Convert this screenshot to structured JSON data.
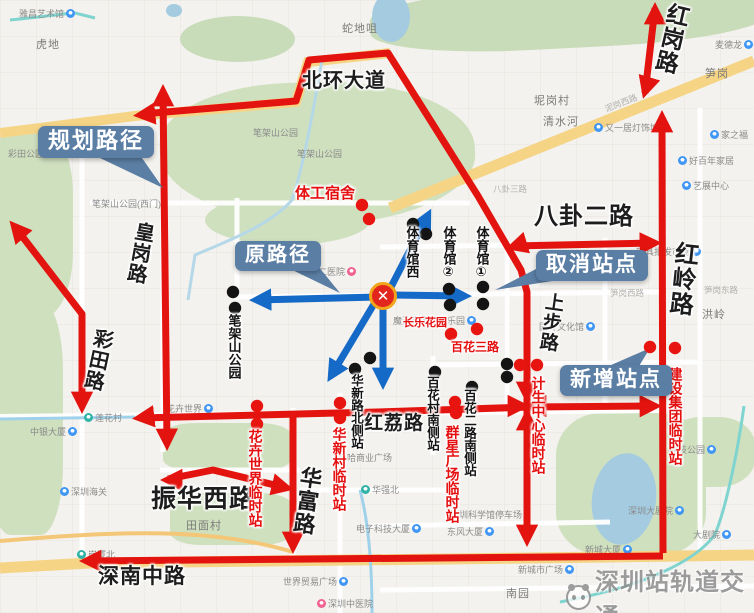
{
  "colors": {
    "route_planned_red": "#e3140f",
    "route_original_blue": "#1569c7",
    "callout_bg": "#5b7ea4",
    "cancelled_dot": "#141414",
    "new_dot": "#e8140f",
    "park_green": "#cfe0bf",
    "road_yellow": "#f5d485",
    "water_blue": "#a4cbe0"
  },
  "callouts": {
    "planned": {
      "label": "规划路径"
    },
    "original": {
      "label": "原路径"
    },
    "cancelled": {
      "label": "取消站点"
    },
    "added": {
      "label": "新增站点"
    }
  },
  "center_marker": {
    "symbol": "✕"
  },
  "watermark": {
    "text": "深圳站轨道交通"
  },
  "road_labels": [
    {
      "text": "北环大道",
      "x": 302,
      "y": 71,
      "size": 20,
      "orient": "h",
      "rot": 0
    },
    {
      "text": "红岗路",
      "x": 658,
      "y": 2,
      "size": 23,
      "orient": "v",
      "rot": 13
    },
    {
      "text": "红岭路",
      "x": 668,
      "y": 241,
      "size": 24,
      "orient": "v",
      "rot": 6
    },
    {
      "text": "八卦二路",
      "x": 534,
      "y": 205,
      "size": 24,
      "orient": "h",
      "rot": 0
    },
    {
      "text": "上步路",
      "x": 540,
      "y": 292,
      "size": 19,
      "orient": "v",
      "rot": 8
    },
    {
      "text": "皇岗路",
      "x": 128,
      "y": 221,
      "size": 20,
      "orient": "v",
      "rot": 10
    },
    {
      "text": "彩田路",
      "x": 86,
      "y": 328,
      "size": 20,
      "orient": "v",
      "rot": 12
    },
    {
      "text": "红荔路",
      "x": 364,
      "y": 414,
      "size": 19,
      "orient": "h",
      "rot": 0
    },
    {
      "text": "华富路",
      "x": 294,
      "y": 466,
      "size": 22,
      "orient": "v",
      "rot": 8
    },
    {
      "text": "振华西路",
      "x": 151,
      "y": 486,
      "size": 25,
      "orient": "h",
      "rot": 0
    },
    {
      "text": "深南中路",
      "x": 98,
      "y": 566,
      "size": 21,
      "orient": "h",
      "rot": 0
    }
  ],
  "stations": [
    {
      "text": "体育馆西",
      "x": 405,
      "y": 226,
      "color": "black",
      "orient": "v",
      "size": 13
    },
    {
      "text": "体育馆②",
      "x": 442,
      "y": 226,
      "color": "black",
      "orient": "v",
      "size": 13
    },
    {
      "text": "体育馆①",
      "x": 475,
      "y": 226,
      "color": "black",
      "orient": "v",
      "size": 13
    },
    {
      "text": "笔架山公园",
      "x": 227,
      "y": 314,
      "color": "black",
      "orient": "v",
      "size": 13
    },
    {
      "text": "华新路北侧站",
      "x": 349,
      "y": 374,
      "color": "black",
      "orient": "v",
      "size": 12.5
    },
    {
      "text": "百花村南侧站",
      "x": 425,
      "y": 376,
      "color": "black",
      "orient": "v",
      "size": 12.5
    },
    {
      "text": "百花二路南侧站",
      "x": 462,
      "y": 389,
      "color": "black",
      "orient": "v",
      "size": 12.5
    },
    {
      "text": "花卉世界临时站",
      "x": 248,
      "y": 429,
      "color": "red",
      "orient": "v",
      "size": 14
    },
    {
      "text": "华新村临时站",
      "x": 332,
      "y": 427,
      "color": "red",
      "orient": "v",
      "size": 14
    },
    {
      "text": "群星广场临时站",
      "x": 445,
      "y": 425,
      "color": "red",
      "orient": "v",
      "size": 14
    },
    {
      "text": "计生中心临时站",
      "x": 531,
      "y": 376,
      "color": "red",
      "orient": "v",
      "size": 14
    },
    {
      "text": "建设集团临时站",
      "x": 668,
      "y": 367,
      "color": "red",
      "orient": "v",
      "size": 14
    },
    {
      "text": "体工宿舍",
      "x": 295,
      "y": 186,
      "color": "red",
      "orient": "h",
      "size": 15
    },
    {
      "text": "长乐花园",
      "x": 403,
      "y": 318,
      "color": "red",
      "orient": "h",
      "size": 11
    },
    {
      "text": "百花三路",
      "x": 451,
      "y": 341,
      "color": "red",
      "orient": "h",
      "size": 12
    }
  ],
  "dots": {
    "cancelled": [
      [
        233,
        292
      ],
      [
        235,
        308
      ],
      [
        413,
        224
      ],
      [
        426,
        234
      ],
      [
        449,
        289
      ],
      [
        450,
        305
      ],
      [
        483,
        287
      ],
      [
        483,
        304
      ],
      [
        370,
        358
      ],
      [
        355,
        369
      ],
      [
        435,
        372
      ],
      [
        472,
        387
      ],
      [
        507,
        364
      ],
      [
        507,
        377
      ]
    ],
    "new": [
      [
        362,
        205
      ],
      [
        369,
        219
      ],
      [
        451,
        334
      ],
      [
        477,
        329
      ],
      [
        520,
        365
      ],
      [
        537,
        365
      ],
      [
        650,
        347
      ],
      [
        675,
        348
      ],
      [
        257,
        406
      ],
      [
        257,
        424
      ],
      [
        340,
        403
      ],
      [
        340,
        418
      ],
      [
        455,
        402
      ],
      [
        456,
        413
      ]
    ]
  },
  "pois": [
    {
      "text": "雅昌艺术馆",
      "x": 19,
      "y": 7,
      "icon": "b",
      "side": "r"
    },
    {
      "text": "虎地",
      "x": 36,
      "y": 36,
      "big": true
    },
    {
      "text": "彩田公园",
      "x": 8,
      "y": 147
    },
    {
      "text": "笔架山公园(西门)",
      "x": 92,
      "y": 197
    },
    {
      "text": "笔架山公园",
      "x": 253,
      "y": 126
    },
    {
      "text": "笔架山公园",
      "x": 297,
      "y": 147
    },
    {
      "text": "蛇地咀",
      "x": 342,
      "y": 20,
      "big": true
    },
    {
      "text": "坭岗村",
      "x": 534,
      "y": 92,
      "big": true
    },
    {
      "text": "清水河",
      "x": 543,
      "y": 113,
      "big": true
    },
    {
      "text": "又一居灯饰城",
      "x": 594,
      "y": 121,
      "icon": "b",
      "side": "l"
    },
    {
      "text": "笋岗",
      "x": 705,
      "y": 65,
      "big": true
    },
    {
      "text": "麦德龙",
      "x": 715,
      "y": 38,
      "icon": "b",
      "side": "r"
    },
    {
      "text": "家之福",
      "x": 710,
      "y": 128,
      "icon": "b",
      "side": "l"
    },
    {
      "text": "好百年家居",
      "x": 678,
      "y": 154,
      "icon": "b",
      "side": "l"
    },
    {
      "text": "艺展中心",
      "x": 682,
      "y": 179,
      "icon": "b",
      "side": "l"
    },
    {
      "text": "玩具批发市场",
      "x": 636,
      "y": 245,
      "icon": "b",
      "side": "r"
    },
    {
      "text": "市第二医院",
      "x": 300,
      "y": 265,
      "icon": "p",
      "side": "r"
    },
    {
      "text": "魔法宝宝儿童乐园",
      "x": 393,
      "y": 314,
      "icon": "b",
      "side": "r"
    },
    {
      "text": "园岭文化馆",
      "x": 539,
      "y": 320,
      "icon": "b",
      "side": "r"
    },
    {
      "text": "洪岭",
      "x": 702,
      "y": 306,
      "big": true
    },
    {
      "text": "笋岗西路",
      "x": 610,
      "y": 287,
      "tiny": true
    },
    {
      "text": "笋岗东路",
      "x": 704,
      "y": 284,
      "tiny": true
    },
    {
      "text": "八卦三路",
      "x": 493,
      "y": 183,
      "tiny": true
    },
    {
      "text": "泥岗西路",
      "x": 604,
      "y": 97,
      "tiny": true,
      "rot": -21
    },
    {
      "text": "荔枝公园",
      "x": 669,
      "y": 443,
      "icon": "b",
      "side": "r"
    },
    {
      "text": "深圳大剧院",
      "x": 628,
      "y": 504,
      "icon": "b",
      "side": "r"
    },
    {
      "text": "大剧院",
      "x": 693,
      "y": 528,
      "icon": "b",
      "side": "r"
    },
    {
      "text": "新城大厦",
      "x": 585,
      "y": 543,
      "icon": "b",
      "side": "r"
    },
    {
      "text": "新城市广场",
      "x": 518,
      "y": 563,
      "icon": "b",
      "side": "r"
    },
    {
      "text": "东风大厦",
      "x": 447,
      "y": 525,
      "icon": "b",
      "side": "r"
    },
    {
      "text": "深圳科学馆停车场",
      "x": 450,
      "y": 508
    },
    {
      "text": "曼哈商业广场",
      "x": 338,
      "y": 451
    },
    {
      "text": "华强北",
      "x": 361,
      "y": 483,
      "icon": "m",
      "side": "l"
    },
    {
      "text": "电子科技大厦",
      "x": 356,
      "y": 522,
      "icon": "b",
      "side": "r"
    },
    {
      "text": "中银大厦",
      "x": 30,
      "y": 425,
      "icon": "b",
      "side": "r"
    },
    {
      "text": "莲花村",
      "x": 84,
      "y": 411,
      "icon": "m",
      "side": "l"
    },
    {
      "text": "深圳海关",
      "x": 60,
      "y": 485,
      "icon": "b",
      "side": "l"
    },
    {
      "text": "岗厦北",
      "x": 77,
      "y": 548,
      "icon": "m",
      "side": "l"
    },
    {
      "text": "田面村",
      "x": 186,
      "y": 517,
      "big": true
    },
    {
      "text": "花卉世界",
      "x": 166,
      "y": 402,
      "icon": "b",
      "side": "r"
    },
    {
      "text": "世界贸易广场",
      "x": 283,
      "y": 575,
      "icon": "b",
      "side": "r"
    },
    {
      "text": "深圳中医院",
      "x": 317,
      "y": 597,
      "icon": "p",
      "side": "l"
    },
    {
      "text": "南园",
      "x": 506,
      "y": 585,
      "big": true
    }
  ]
}
